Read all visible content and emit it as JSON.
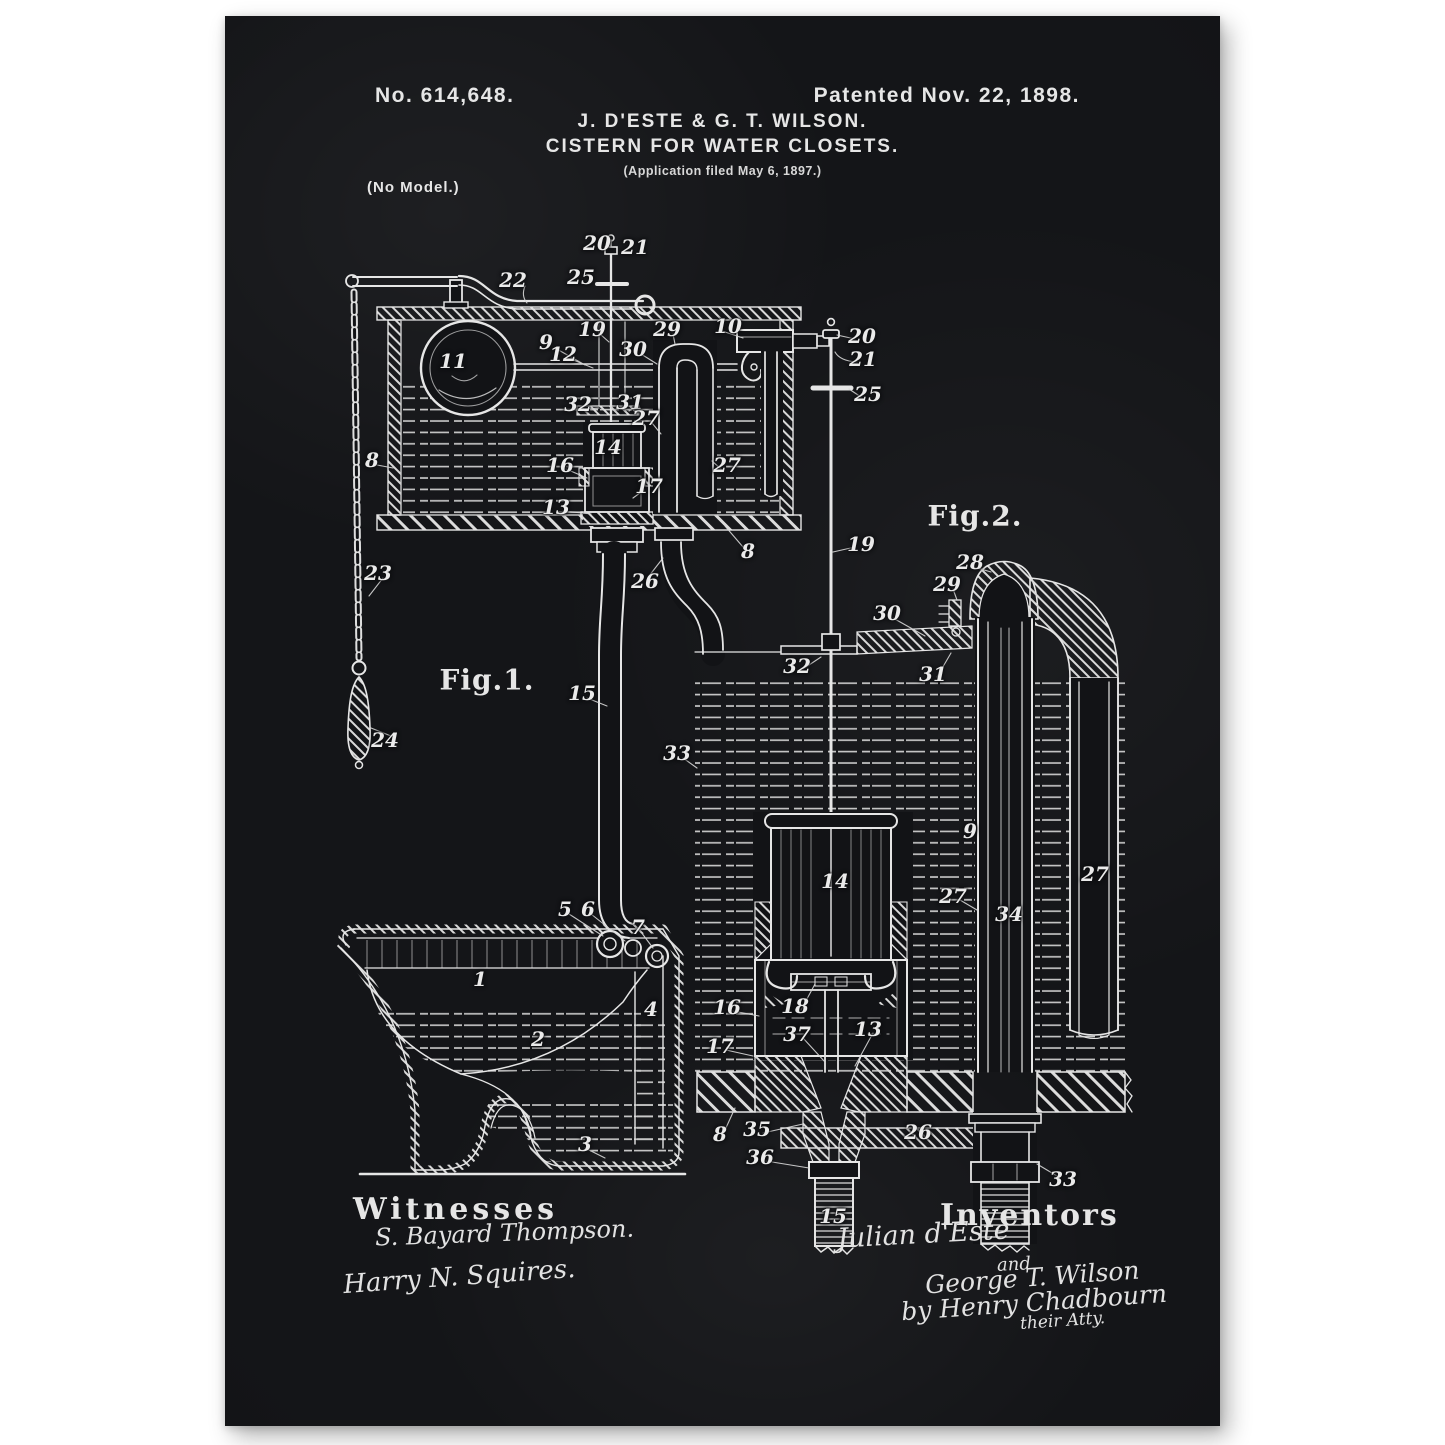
{
  "poster": {
    "background_color": "#121316",
    "ink_color": "#e6e6e6",
    "header": {
      "patent_number": "No. 614,648.",
      "patent_date": "Patented Nov. 22, 1898.",
      "inventors_line": "J. D'ESTE & G. T. WILSON.",
      "title": "CISTERN FOR WATER CLOSETS.",
      "application_line": "(Application filed May 6, 1897.)",
      "model_note": "(No Model.)"
    },
    "figures": [
      {
        "label": "Fig.1."
      },
      {
        "label": "Fig.2."
      }
    ],
    "footer": {
      "witnesses_heading": "Witnesses",
      "witness_signatures": [
        "S. Bayard Thompson.",
        "Harry N. Squires."
      ],
      "inventors_heading": "Inventors",
      "inventor_signatures": [
        "Julian d'Este",
        "and",
        "George T. Wilson",
        "by Henry Chadbourn",
        "their Atty."
      ]
    },
    "reference_labels": [
      {
        "fig": 1,
        "text": "20",
        "x": 372,
        "y": 227
      },
      {
        "fig": 1,
        "text": "21",
        "x": 410,
        "y": 231
      },
      {
        "fig": 1,
        "text": "25",
        "x": 356,
        "y": 261
      },
      {
        "fig": 1,
        "text": "22",
        "x": 288,
        "y": 264
      },
      {
        "fig": 1,
        "text": "19",
        "x": 367,
        "y": 313
      },
      {
        "fig": 1,
        "text": "9",
        "x": 321,
        "y": 326
      },
      {
        "fig": 1,
        "text": "12",
        "x": 338,
        "y": 338
      },
      {
        "fig": 1,
        "text": "30",
        "x": 408,
        "y": 333
      },
      {
        "fig": 1,
        "text": "29",
        "x": 442,
        "y": 313
      },
      {
        "fig": 1,
        "text": "10",
        "x": 503,
        "y": 310
      },
      {
        "fig": 1,
        "text": "11",
        "x": 228,
        "y": 345
      },
      {
        "fig": 1,
        "text": "32",
        "x": 353,
        "y": 388
      },
      {
        "fig": 1,
        "text": "31",
        "x": 405,
        "y": 386
      },
      {
        "fig": 1,
        "text": "27",
        "x": 421,
        "y": 402
      },
      {
        "fig": 1,
        "text": "14",
        "x": 383,
        "y": 431
      },
      {
        "fig": 1,
        "text": "16",
        "x": 335,
        "y": 449
      },
      {
        "fig": 1,
        "text": "17",
        "x": 424,
        "y": 470
      },
      {
        "fig": 1,
        "text": "13",
        "x": 331,
        "y": 491
      },
      {
        "fig": 1,
        "text": "8",
        "x": 147,
        "y": 444
      },
      {
        "fig": 1,
        "text": "27",
        "x": 502,
        "y": 449
      },
      {
        "fig": 1,
        "text": "8",
        "x": 523,
        "y": 535
      },
      {
        "fig": 1,
        "text": "26",
        "x": 420,
        "y": 565
      },
      {
        "fig": 1,
        "text": "23",
        "x": 153,
        "y": 557
      },
      {
        "fig": 1,
        "text": "15",
        "x": 357,
        "y": 677
      },
      {
        "fig": 1,
        "text": "33",
        "x": 452,
        "y": 737
      },
      {
        "fig": 1,
        "text": "24",
        "x": 160,
        "y": 724
      },
      {
        "fig": 1,
        "text": "5",
        "x": 340,
        "y": 893
      },
      {
        "fig": 1,
        "text": "6",
        "x": 363,
        "y": 893
      },
      {
        "fig": 1,
        "text": "7",
        "x": 413,
        "y": 911
      },
      {
        "fig": 1,
        "text": "1",
        "x": 255,
        "y": 963
      },
      {
        "fig": 1,
        "text": "4",
        "x": 426,
        "y": 993
      },
      {
        "fig": 1,
        "text": "2",
        "x": 313,
        "y": 1023
      },
      {
        "fig": 1,
        "text": "3",
        "x": 360,
        "y": 1128
      },
      {
        "fig": 2,
        "text": "20",
        "x": 637,
        "y": 320
      },
      {
        "fig": 2,
        "text": "21",
        "x": 638,
        "y": 343
      },
      {
        "fig": 2,
        "text": "25",
        "x": 643,
        "y": 378
      },
      {
        "fig": 2,
        "text": "19",
        "x": 636,
        "y": 528
      },
      {
        "fig": 2,
        "text": "28",
        "x": 745,
        "y": 546
      },
      {
        "fig": 2,
        "text": "29",
        "x": 722,
        "y": 568
      },
      {
        "fig": 2,
        "text": "30",
        "x": 662,
        "y": 597
      },
      {
        "fig": 2,
        "text": "31",
        "x": 708,
        "y": 658
      },
      {
        "fig": 2,
        "text": "32",
        "x": 572,
        "y": 650
      },
      {
        "fig": 2,
        "text": "9",
        "x": 745,
        "y": 815
      },
      {
        "fig": 2,
        "text": "14",
        "x": 610,
        "y": 865
      },
      {
        "fig": 2,
        "text": "27",
        "x": 728,
        "y": 880
      },
      {
        "fig": 2,
        "text": "34",
        "x": 784,
        "y": 898
      },
      {
        "fig": 2,
        "text": "27",
        "x": 870,
        "y": 858
      },
      {
        "fig": 2,
        "text": "16",
        "x": 502,
        "y": 991
      },
      {
        "fig": 2,
        "text": "18",
        "x": 570,
        "y": 990
      },
      {
        "fig": 2,
        "text": "37",
        "x": 572,
        "y": 1018
      },
      {
        "fig": 2,
        "text": "13",
        "x": 643,
        "y": 1013
      },
      {
        "fig": 2,
        "text": "17",
        "x": 495,
        "y": 1030
      },
      {
        "fig": 2,
        "text": "8",
        "x": 495,
        "y": 1118
      },
      {
        "fig": 2,
        "text": "35",
        "x": 532,
        "y": 1113
      },
      {
        "fig": 2,
        "text": "36",
        "x": 535,
        "y": 1141
      },
      {
        "fig": 2,
        "text": "26",
        "x": 693,
        "y": 1116
      },
      {
        "fig": 2,
        "text": "33",
        "x": 838,
        "y": 1163
      },
      {
        "fig": 2,
        "text": "15",
        "x": 608,
        "y": 1200
      }
    ]
  }
}
